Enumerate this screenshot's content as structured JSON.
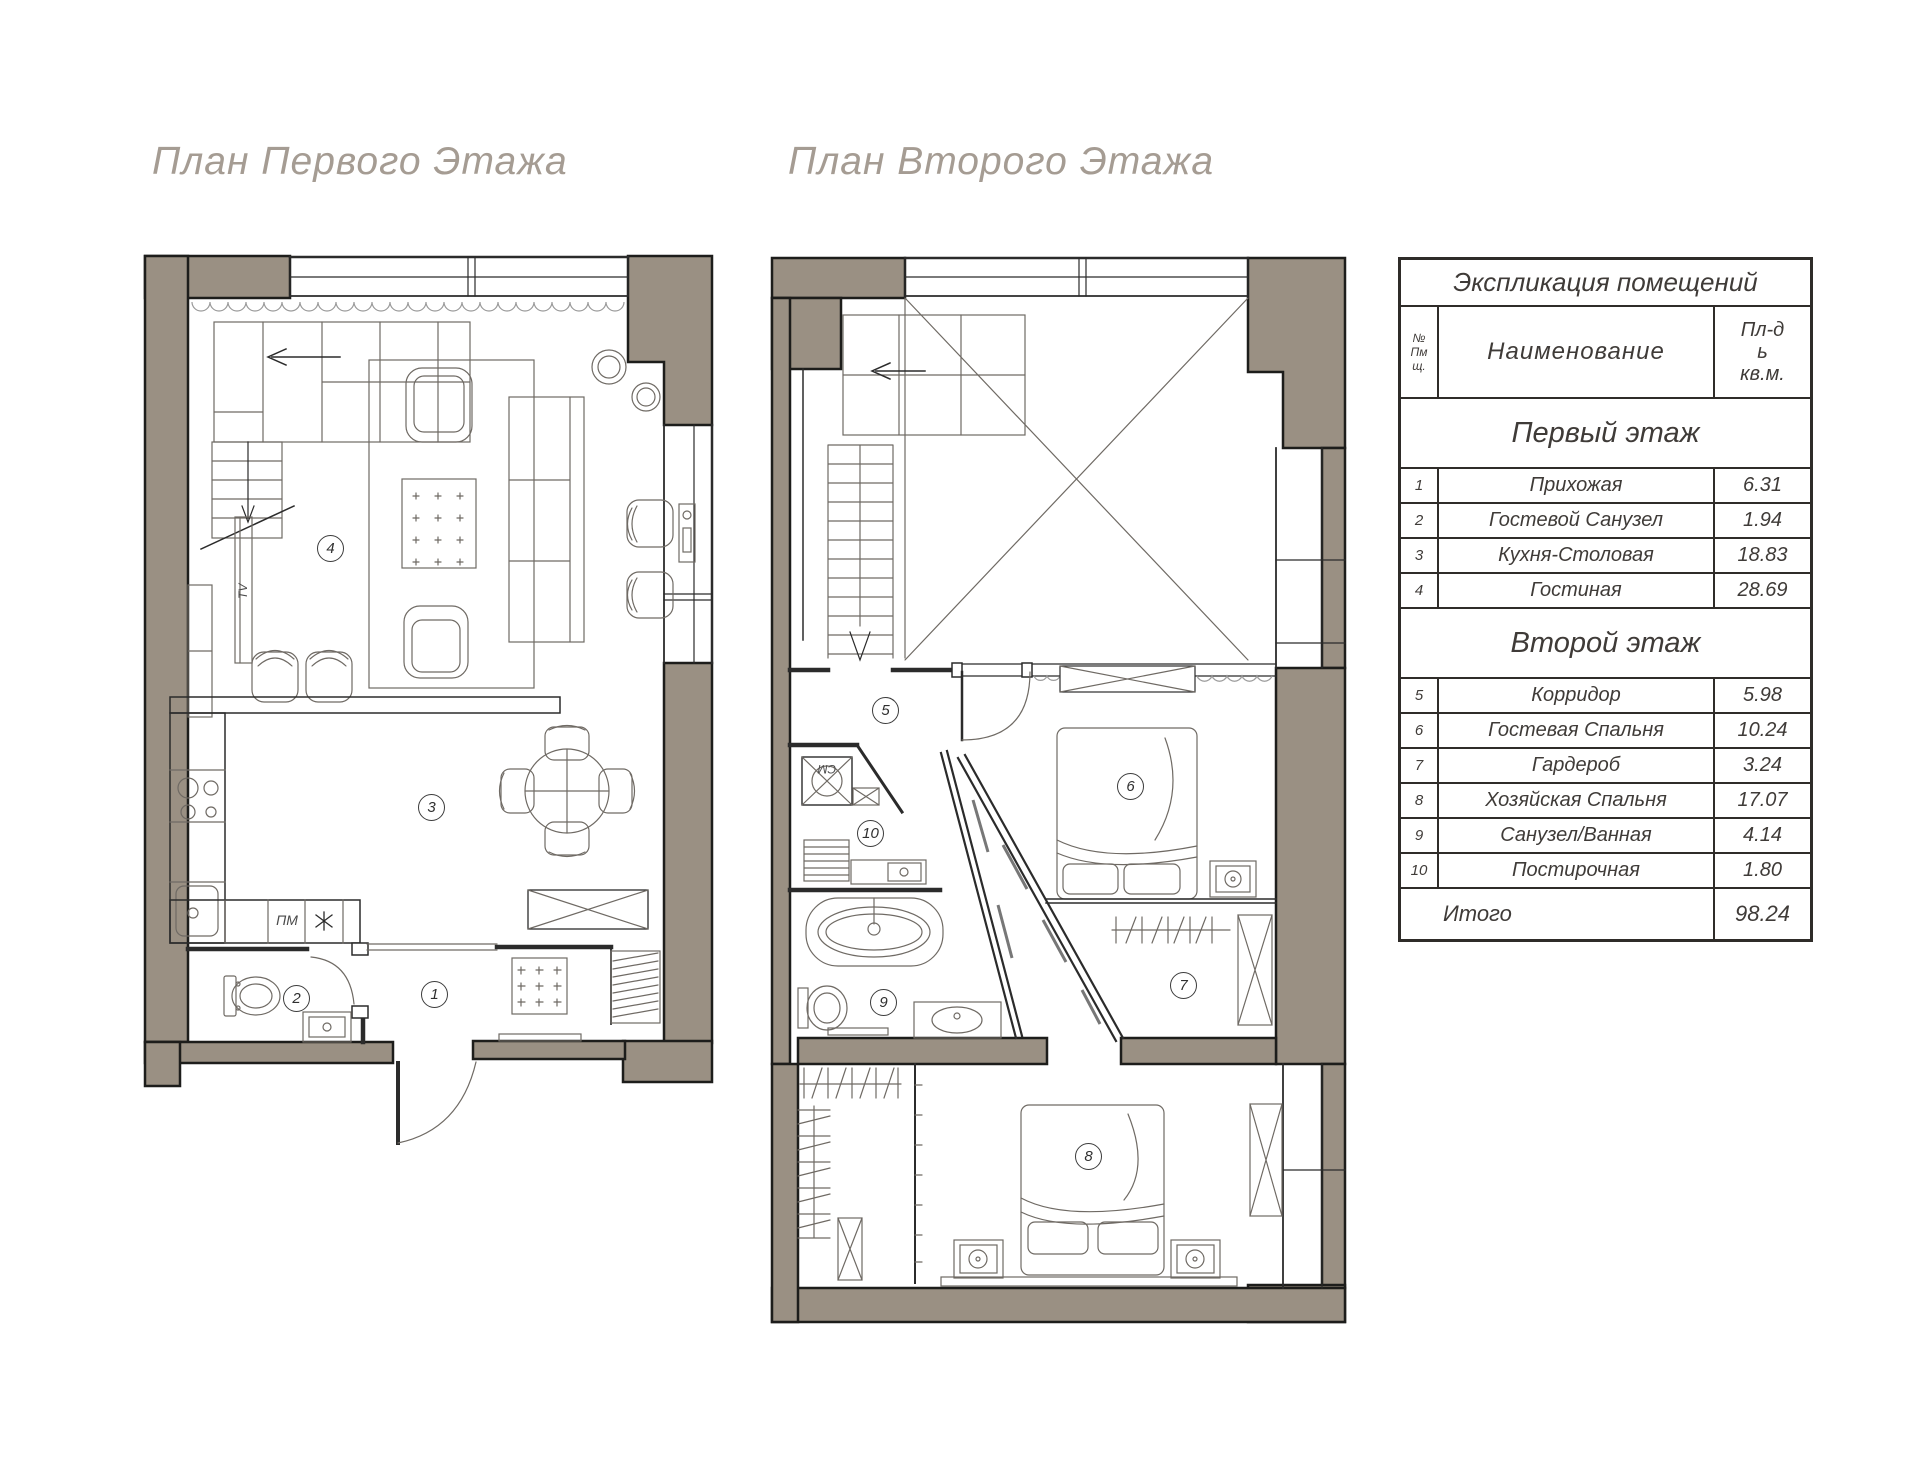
{
  "colors": {
    "wall_fill": "#9a9083",
    "wall_outline": "#1d1d1b",
    "thin_line": "#2b2b2b",
    "furniture_line": "#6f6a64",
    "title_text": "#a59c93",
    "table_text": "#3f3b38"
  },
  "titles": {
    "plan1": "План Первого Этажа",
    "plan2": "План Второго Этажа"
  },
  "plan1": {
    "room_numbers": [
      "1",
      "2",
      "3",
      "4"
    ],
    "labels": {
      "tv": "TV",
      "dishwasher": "ПМ"
    },
    "icons": {
      "fridge": "snowflake-icon"
    }
  },
  "plan2": {
    "room_numbers": [
      "5",
      "6",
      "7",
      "8",
      "9",
      "10"
    ],
    "labels": {
      "washer": "СМ"
    }
  },
  "explication": {
    "title": "Экспликация помещений",
    "header": {
      "num_lines": [
        "№",
        "Пм",
        "щ."
      ],
      "name": "Наименование",
      "area_lines": [
        "Пл-д",
        "ь",
        "кв.м."
      ]
    },
    "sections": [
      {
        "title": "Первый этаж",
        "rows": [
          {
            "num": "1",
            "name": "Прихожая",
            "area": "6.31"
          },
          {
            "num": "2",
            "name": "Гостевой Санузел",
            "area": "1.94"
          },
          {
            "num": "3",
            "name": "Кухня-Столовая",
            "area": "18.83"
          },
          {
            "num": "4",
            "name": "Гостиная",
            "area": "28.69"
          }
        ]
      },
      {
        "title": "Второй этаж",
        "rows": [
          {
            "num": "5",
            "name": "Корридор",
            "area": "5.98"
          },
          {
            "num": "6",
            "name": "Гостевая Спальня",
            "area": "10.24"
          },
          {
            "num": "7",
            "name": "Гардероб",
            "area": "3.24"
          },
          {
            "num": "8",
            "name": "Хозяйская Спальня",
            "area": "17.07"
          },
          {
            "num": "9",
            "name": "Санузел/Ванная",
            "area": "4.14"
          },
          {
            "num": "10",
            "name": "Постирочная",
            "area": "1.80"
          }
        ]
      }
    ],
    "total": {
      "label": "Итого",
      "value": "98.24"
    }
  }
}
